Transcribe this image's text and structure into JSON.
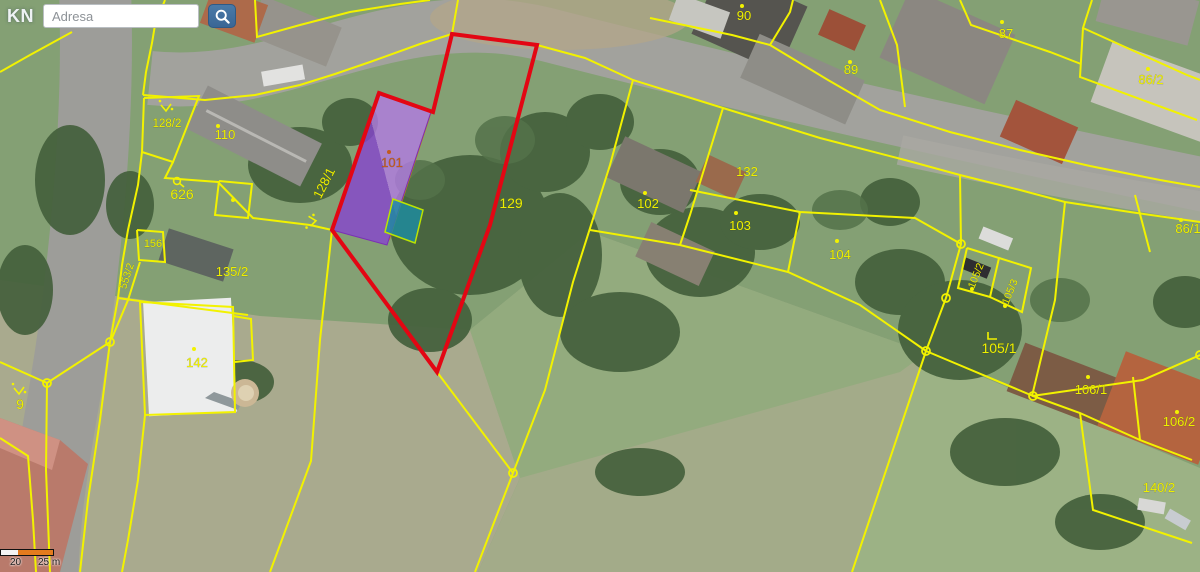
{
  "search": {
    "kn_label": "KN",
    "placeholder": "Adresa"
  },
  "scalebar": {
    "label_20": "20",
    "label_25": "25 m"
  },
  "map": {
    "line_color": "#f2f200",
    "red_color": "#e30613",
    "label_color": "#eef000",
    "purple_dark": "#8644cf",
    "purple_light": "#b27ae3",
    "teal_fill": "#1d8da2",
    "teal_stroke": "#bce400",
    "orange_line": "#cc8a00",
    "accent_101": "#c25a1e",
    "labels": [
      {
        "t": "90",
        "x": 744,
        "y": 20
      },
      {
        "t": "89",
        "x": 851,
        "y": 74
      },
      {
        "t": "87",
        "x": 1006,
        "y": 38
      },
      {
        "t": "86/2",
        "x": 1151,
        "y": 84
      },
      {
        "t": "86/1",
        "x": 1188,
        "y": 233
      },
      {
        "t": "110",
        "x": 225,
        "y": 139
      },
      {
        "t": "128/2",
        "x": 167,
        "y": 127,
        "fs": 11.5
      },
      {
        "t": "626",
        "x": 182,
        "y": 199,
        "fs": 14
      },
      {
        "t": "128/1",
        "x": 328,
        "y": 185,
        "r": -63
      },
      {
        "t": "101",
        "x": 392,
        "y": 167,
        "c": "#c25a1e"
      },
      {
        "t": "129",
        "x": 511,
        "y": 208,
        "fs": 14
      },
      {
        "t": "132",
        "x": 747,
        "y": 176
      },
      {
        "t": "102",
        "x": 648,
        "y": 208
      },
      {
        "t": "103",
        "x": 740,
        "y": 230
      },
      {
        "t": "104",
        "x": 840,
        "y": 259
      },
      {
        "t": "105/2",
        "x": 979,
        "y": 277,
        "r": -68,
        "fs": 10.5
      },
      {
        "t": "105/3",
        "x": 1013,
        "y": 293,
        "r": -68,
        "fs": 10.5
      },
      {
        "t": "105/1",
        "x": 999,
        "y": 353,
        "fs": 14
      },
      {
        "t": "106/1",
        "x": 1091,
        "y": 394
      },
      {
        "t": "106/2",
        "x": 1179,
        "y": 426
      },
      {
        "t": "140/2",
        "x": 1159,
        "y": 492
      },
      {
        "t": "135/2",
        "x": 232,
        "y": 276
      },
      {
        "t": "142",
        "x": 197,
        "y": 367
      },
      {
        "t": "156",
        "x": 153,
        "y": 247,
        "fs": 11
      },
      {
        "t": "553/2",
        "x": 130,
        "y": 277,
        "r": -72,
        "fs": 10.5
      },
      {
        "t": "9",
        "x": 20,
        "y": 409,
        "fs": 14
      }
    ],
    "dots": [
      [
        742,
        6
      ],
      [
        850,
        62
      ],
      [
        1002,
        22
      ],
      [
        1148,
        69
      ],
      [
        1181,
        220
      ],
      [
        218,
        126
      ],
      [
        645,
        193
      ],
      [
        736,
        213
      ],
      [
        837,
        241
      ],
      [
        1088,
        377
      ],
      [
        1177,
        412
      ],
      [
        194,
        349
      ],
      [
        233,
        200
      ],
      [
        972,
        289
      ],
      [
        1005,
        306
      ]
    ],
    "orange_dot": [
      389,
      152
    ],
    "rings": [
      [
        513,
        473
      ],
      [
        110,
        342
      ],
      [
        47,
        383
      ],
      [
        961,
        244
      ],
      [
        946,
        298
      ],
      [
        926,
        351
      ],
      [
        1033,
        396
      ],
      [
        1200,
        355
      ]
    ],
    "symbols": [
      {
        "type": "check",
        "x": 166,
        "y": 108
      },
      {
        "type": "check",
        "x": 19,
        "y": 391
      },
      {
        "type": "check",
        "x": 313,
        "y": 221,
        "r": -95
      },
      {
        "type": "loop",
        "x": 177,
        "y": 182
      },
      {
        "type": "corner",
        "x": 992,
        "y": 336
      }
    ],
    "red_polygon": [
      [
        452,
        34
      ],
      [
        537,
        45
      ],
      [
        490,
        225
      ],
      [
        437,
        372
      ],
      [
        332,
        230
      ],
      [
        379,
        93
      ],
      [
        433,
        112
      ]
    ],
    "purple_polygon": [
      [
        377,
        94
      ],
      [
        431,
        112
      ],
      [
        387,
        245
      ],
      [
        332,
        230
      ]
    ],
    "teal_polygon": [
      [
        393,
        199
      ],
      [
        423,
        210
      ],
      [
        415,
        243
      ],
      [
        385,
        232
      ]
    ],
    "orange_segment": [
      [
        431,
        112
      ],
      [
        389,
        240
      ]
    ],
    "lines": [
      [
        [
          458,
          0
        ],
        [
          452,
          34
        ]
      ],
      [
        [
          452,
          34
        ],
        [
          420,
          44
        ],
        [
          370,
          62
        ],
        [
          335,
          74
        ],
        [
          300,
          85
        ],
        [
          255,
          95
        ],
        [
          205,
          100
        ],
        [
          143,
          95
        ]
      ],
      [
        [
          165,
          0
        ],
        [
          155,
          25
        ],
        [
          152,
          43
        ],
        [
          146,
          72
        ],
        [
          143,
          95
        ]
      ],
      [
        [
          144,
          98
        ],
        [
          199,
          96
        ],
        [
          173,
          162
        ],
        [
          142,
          152
        ],
        [
          144,
          98
        ]
      ],
      [
        [
          142,
          152
        ],
        [
          138,
          185
        ],
        [
          128,
          230
        ],
        [
          122,
          265
        ],
        [
          118,
          298
        ],
        [
          110,
          342
        ]
      ],
      [
        [
          173,
          162
        ],
        [
          165,
          178
        ],
        [
          218,
          182
        ],
        [
          253,
          218
        ],
        [
          310,
          225
        ],
        [
          332,
          230
        ]
      ],
      [
        [
          219,
          181
        ],
        [
          252,
          184
        ],
        [
          248,
          218
        ],
        [
          215,
          215
        ],
        [
          219,
          181
        ]
      ],
      [
        [
          332,
          230
        ],
        [
          320,
          340
        ],
        [
          311,
          461
        ],
        [
          270,
          572
        ]
      ],
      [
        [
          110,
          342
        ],
        [
          100,
          420
        ],
        [
          88,
          500
        ],
        [
          80,
          572
        ]
      ],
      [
        [
          140,
          262
        ],
        [
          128,
          300
        ],
        [
          112,
          338
        ]
      ],
      [
        [
          137,
          230
        ],
        [
          163,
          232
        ],
        [
          165,
          262
        ],
        [
          139,
          260
        ],
        [
          137,
          230
        ]
      ],
      [
        [
          118,
          298
        ],
        [
          132,
          300
        ],
        [
          248,
          315
        ]
      ],
      [
        [
          233,
          316
        ],
        [
          251,
          319
        ],
        [
          253,
          360
        ],
        [
          235,
          362
        ]
      ],
      [
        [
          140,
          302
        ],
        [
          233,
          307
        ],
        [
          235,
          412
        ],
        [
          145,
          415
        ],
        [
          140,
          302
        ]
      ],
      [
        [
          145,
          415
        ],
        [
          138,
          480
        ],
        [
          128,
          540
        ],
        [
          122,
          572
        ]
      ],
      [
        [
          437,
          372
        ],
        [
          513,
          473
        ]
      ],
      [
        [
          513,
          473
        ],
        [
          475,
          572
        ]
      ],
      [
        [
          513,
          473
        ],
        [
          545,
          390
        ],
        [
          573,
          282
        ],
        [
          610,
          165
        ],
        [
          633,
          80
        ]
      ],
      [
        [
          537,
          45
        ],
        [
          585,
          58
        ],
        [
          633,
          80
        ],
        [
          723,
          108
        ],
        [
          820,
          138
        ],
        [
          905,
          160
        ],
        [
          960,
          175
        ],
        [
          1020,
          190
        ],
        [
          1065,
          202
        ],
        [
          1130,
          212
        ],
        [
          1200,
          222
        ]
      ],
      [
        [
          723,
          108
        ],
        [
          710,
          150
        ],
        [
          690,
          215
        ],
        [
          680,
          245
        ]
      ],
      [
        [
          690,
          190
        ],
        [
          800,
          212
        ],
        [
          915,
          218
        ],
        [
          961,
          244
        ]
      ],
      [
        [
          800,
          212
        ],
        [
          788,
          272
        ]
      ],
      [
        [
          590,
          230
        ],
        [
          680,
          245
        ],
        [
          788,
          272
        ],
        [
          860,
          305
        ],
        [
          926,
          351
        ]
      ],
      [
        [
          960,
          175
        ],
        [
          961,
          244
        ],
        [
          946,
          298
        ],
        [
          926,
          351
        ]
      ],
      [
        [
          926,
          351
        ],
        [
          852,
          572
        ]
      ],
      [
        [
          926,
          351
        ],
        [
          1033,
          396
        ]
      ],
      [
        [
          1065,
          202
        ],
        [
          1060,
          250
        ],
        [
          1055,
          300
        ],
        [
          1032,
          396
        ]
      ],
      [
        [
          1033,
          396
        ],
        [
          1080,
          413
        ],
        [
          1140,
          440
        ],
        [
          1192,
          460
        ]
      ],
      [
        [
          1080,
          413
        ],
        [
          1093,
          510
        ],
        [
          1192,
          543
        ]
      ],
      [
        [
          1032,
          396
        ],
        [
          1143,
          380
        ],
        [
          1200,
          355
        ]
      ],
      [
        [
          1133,
          377
        ],
        [
          1140,
          440
        ]
      ],
      [
        [
          967,
          248
        ],
        [
          999,
          258
        ],
        [
          990,
          297
        ],
        [
          958,
          288
        ],
        [
          967,
          248
        ]
      ],
      [
        [
          999,
          258
        ],
        [
          1031,
          268
        ],
        [
          1022,
          312
        ],
        [
          990,
          297
        ]
      ],
      [
        [
          650,
          18
        ],
        [
          732,
          35
        ],
        [
          770,
          45
        ]
      ],
      [
        [
          770,
          45
        ],
        [
          790,
          12
        ],
        [
          793,
          0
        ]
      ],
      [
        [
          770,
          45
        ],
        [
          828,
          80
        ],
        [
          880,
          110
        ],
        [
          950,
          132
        ],
        [
          1020,
          150
        ],
        [
          1090,
          166
        ],
        [
          1160,
          180
        ],
        [
          1200,
          187
        ]
      ],
      [
        [
          880,
          0
        ],
        [
          897,
          45
        ],
        [
          905,
          107
        ]
      ],
      [
        [
          1092,
          0
        ],
        [
          1083,
          28
        ],
        [
          1187,
          75
        ],
        [
          1200,
          80
        ]
      ],
      [
        [
          1083,
          28
        ],
        [
          1080,
          77
        ],
        [
          1197,
          120
        ]
      ],
      [
        [
          960,
          0
        ],
        [
          971,
          25
        ],
        [
          1050,
          52
        ],
        [
          1081,
          64
        ]
      ],
      [
        [
          1135,
          195
        ],
        [
          1150,
          252
        ]
      ],
      [
        [
          0,
          362
        ],
        [
          47,
          383
        ]
      ],
      [
        [
          47,
          383
        ],
        [
          46,
          470
        ],
        [
          50,
          572
        ]
      ],
      [
        [
          110,
          342
        ],
        [
          47,
          383
        ]
      ],
      [
        [
          0,
          438
        ],
        [
          28,
          456
        ],
        [
          33,
          520
        ],
        [
          36,
          572
        ]
      ],
      [
        [
          72,
          32
        ],
        [
          30,
          55
        ],
        [
          0,
          72
        ]
      ],
      [
        [
          255,
          0
        ],
        [
          257,
          37
        ],
        [
          300,
          25
        ],
        [
          350,
          12
        ],
        [
          400,
          4
        ],
        [
          430,
          0
        ]
      ]
    ]
  }
}
